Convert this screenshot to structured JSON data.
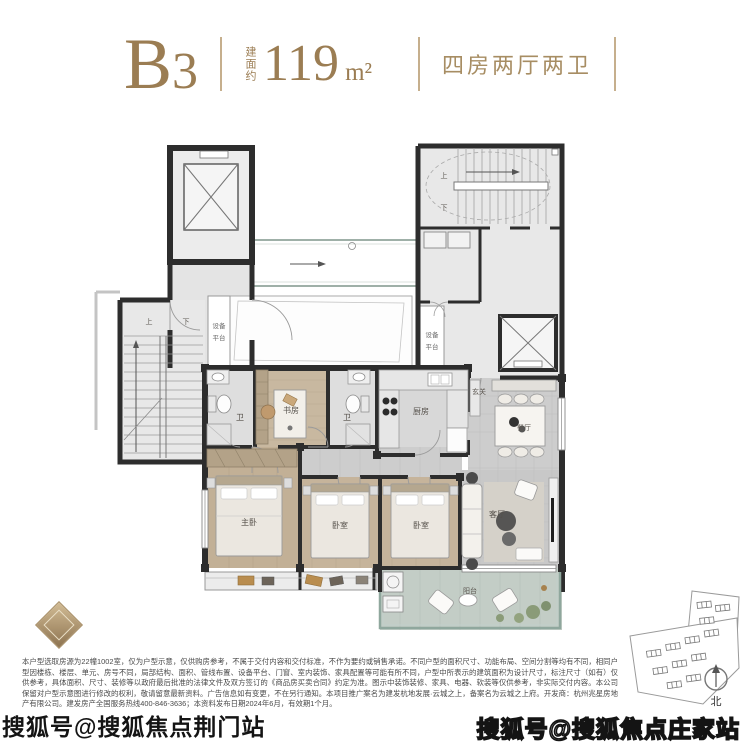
{
  "header": {
    "unit_letter": "B",
    "unit_number": "3",
    "area_prefix": "建面约",
    "area_value": "119",
    "area_unit": "m²",
    "layout_type": "四房两厅两卫"
  },
  "plan": {
    "labels": {
      "equip_line1": "设备",
      "equip_line2": "平台",
      "bath": "卫",
      "study": "书房",
      "kitchen": "厨房",
      "foyer": "玄关",
      "dining": "餐厅",
      "master": "主卧",
      "bedroom": "卧室",
      "living": "客厅",
      "balcony": "阳台",
      "up": "上",
      "down": "下"
    }
  },
  "siteplan": {
    "north": "北"
  },
  "watermarks": {
    "bottom_left": "搜狐号@搜狐焦点荆门站",
    "bottom_right": "搜狐号@搜狐焦点庄家站"
  },
  "disclaimer": "本户型选取房源为22幢1002室，仅为户型示意，仅供购房参考，不属于交付内容和交付标准，不作为要约或销售承诺。不同户型的面积尺寸、功能布局、空间分割等均有不同，相同户型因楼栋、楼层、单元、房号不同，局部结构、面积、管线布置、设备平台、门窗、室内装饰、家具配置等可能有所不同，户型中所表示的建筑面积为设计尺寸，标注尺寸（如有）仅供参考，具体面积、尺寸、装修等以政府最后批准的法律文件及双方签订的《商品房买卖合同》约定为准。图示中装饰装修、家具、电器、软装等仅供参考，非实际交付内容。本公司保留对户型示意图进行修改的权利，敬请留意最新资料。广告信息如有变更，不在另行通知。本项目推广案名为建发杭地发展·云城之上，备案名为云城之上府。开发商：杭州兆星房地产有限公司。建发房产全国服务热线400-846-3636；本资料发布日期2024年6月，有效期1个月。",
  "colors": {
    "accent": "#9b7d53",
    "wall": "#2d2d2d",
    "watermark": "#141414"
  }
}
